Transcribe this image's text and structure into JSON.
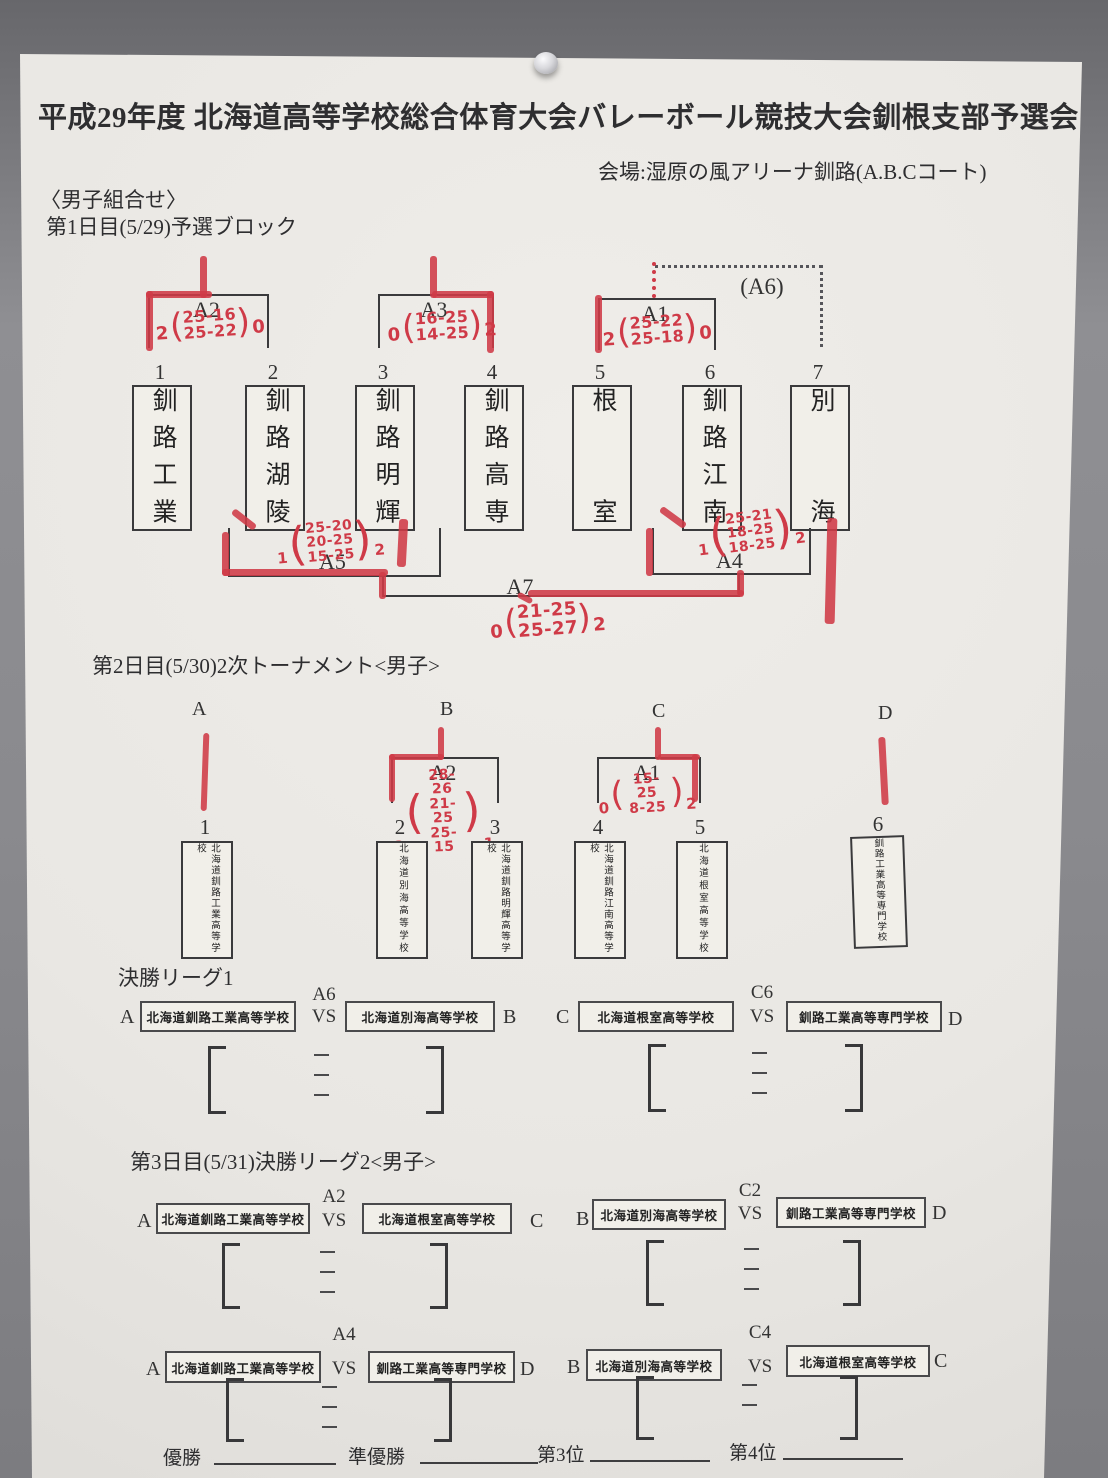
{
  "header": {
    "title": "平成29年度 北海道高等学校総合体育大会バレーボール競技大会釧根支部予選会",
    "venue": "会場:湿原の風アリーナ釧路(A.B.Cコート)",
    "group_label": "〈男子組合せ〉",
    "day1": "第1日目(5/29)予選ブロック",
    "day2": "第2日目(5/30)2次トーナメント<男子>",
    "league1": "決勝リーグ1",
    "day3": "第3日目(5/31)決勝リーグ2<男子>"
  },
  "glyphs": {
    "open": "(",
    "close": ")"
  },
  "day1": {
    "teams": [
      {
        "no": "1",
        "name": "釧路工業"
      },
      {
        "no": "2",
        "name": "釧路湖陵"
      },
      {
        "no": "3",
        "name": "釧路明輝"
      },
      {
        "no": "4",
        "name": "釧路高専"
      },
      {
        "no": "5",
        "name": "根室"
      },
      {
        "no": "6",
        "name": "釧路江南"
      },
      {
        "no": "7",
        "name": "別海"
      }
    ],
    "matches": {
      "a2": {
        "label": "A2",
        "w_left": "2",
        "w_right": "0",
        "sets": [
          "25-16",
          "25-22"
        ]
      },
      "a3": {
        "label": "A3",
        "w_left": "0",
        "w_right": "2",
        "sets": [
          "16-25",
          "14-25"
        ]
      },
      "a1": {
        "label": "A1",
        "w_left": "2",
        "w_right": "0",
        "sets": [
          "25-22",
          "25-18"
        ]
      },
      "a6_label": "(A6)",
      "a5": {
        "label": "A5",
        "w_left": "1",
        "w_right": "2",
        "sets": [
          "25-20",
          "20-25",
          "15-25"
        ]
      },
      "a4": {
        "label": "A4",
        "w_left": "1",
        "w_right": "2",
        "sets": [
          "25-21",
          "18-25",
          "18-25"
        ]
      },
      "a7": {
        "label": "A7",
        "w_left": "0",
        "w_right": "2",
        "sets": [
          "21-25",
          "25-27"
        ]
      }
    }
  },
  "day2": {
    "letters": [
      "A",
      "B",
      "C",
      "D"
    ],
    "teams": [
      {
        "no": "1",
        "name": "北海道釧路工業高等学校"
      },
      {
        "no": "2",
        "name": "北海道別海高等学校"
      },
      {
        "no": "3",
        "name": "北海道釧路明輝高等学校"
      },
      {
        "no": "4",
        "name": "北海道釧路江南高等学校"
      },
      {
        "no": "5",
        "name": "北海道根室高等学校"
      },
      {
        "no": "6",
        "name": "釧路工業高等専門学校"
      }
    ],
    "matches": {
      "a2": {
        "label": "A2",
        "w_left": "2",
        "w_right": "1",
        "sets": [
          "28-26",
          "21-25",
          "25-15"
        ]
      },
      "a1": {
        "label": "A1",
        "w_left": "0",
        "w_right": "2",
        "sets": [
          "15-25",
          "8-25"
        ]
      }
    }
  },
  "league1": {
    "m1": {
      "l": "A",
      "lt": "北海道釧路工業高等学校",
      "code": "A6",
      "vs": "VS",
      "rt": "北海道別海高等学校",
      "r": "B"
    },
    "m2": {
      "l": "C",
      "lt": "北海道根室高等学校",
      "code": "C6",
      "vs": "VS",
      "rt": "釧路工業高等専門学校",
      "r": "D"
    }
  },
  "league2": {
    "r1m1": {
      "l": "A",
      "lt": "北海道釧路工業高等学校",
      "code": "A2",
      "vs": "VS",
      "rt": "北海道根室高等学校",
      "r": "C"
    },
    "r1m2": {
      "l": "B",
      "lt": "北海道別海高等学校",
      "code": "C2",
      "vs": "VS",
      "rt": "釧路工業高等専門学校",
      "r": "D"
    },
    "r2m1": {
      "l": "A",
      "lt": "北海道釧路工業高等学校",
      "code": "A4",
      "vs": "VS",
      "rt": "釧路工業高等専門学校",
      "r": "D"
    },
    "r2m2": {
      "l": "B",
      "lt": "北海道別海高等学校",
      "code": "C4",
      "vs": "VS",
      "rt": "北海道根室高等学校",
      "r": "C"
    }
  },
  "footer": {
    "labels": [
      "優勝",
      "準優勝",
      "第3位",
      "第4位"
    ]
  }
}
